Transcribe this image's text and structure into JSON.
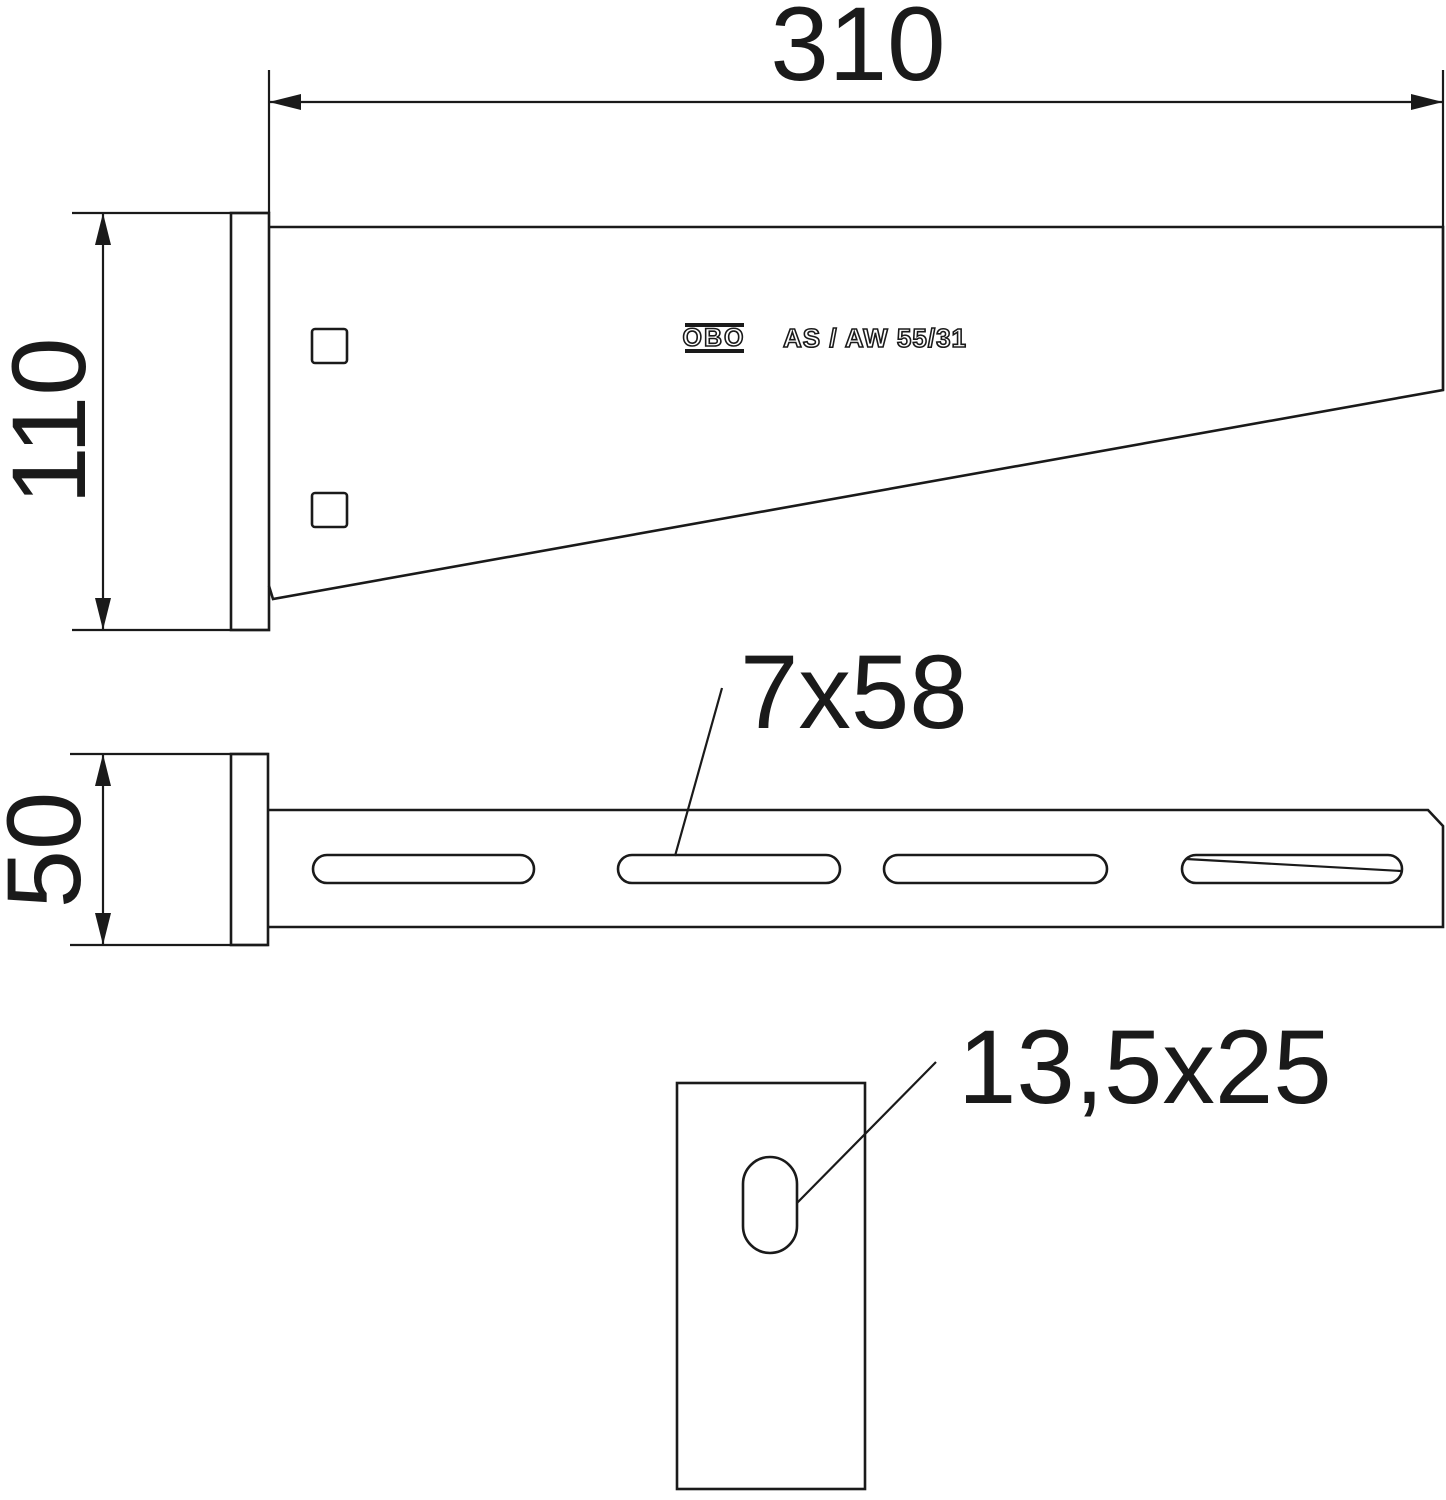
{
  "drawing": {
    "brand": "OBO",
    "product_label": "AS / AW 55/31",
    "dimensions": {
      "arm_length": "310",
      "wall_plate_height": "110",
      "plate_width": "50",
      "slot_size": "7x58",
      "anchor_hole_size": "13,5x25"
    },
    "colors": {
      "line": "#1a1a1a",
      "background": "#ffffff"
    }
  }
}
